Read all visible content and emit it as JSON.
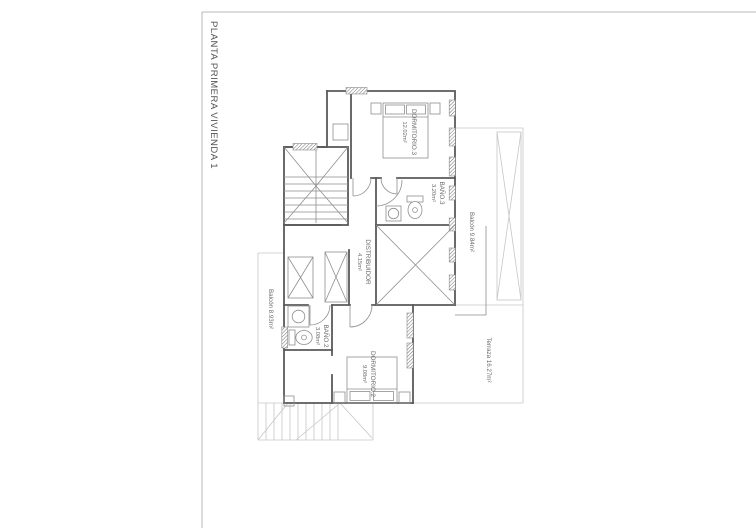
{
  "sheet": {
    "title": "PLANTA PRIMERA VIVIENDA 1"
  },
  "rooms": [
    {
      "name": "DORMITORIO.3",
      "area": "12.02m²"
    },
    {
      "name": "BAÑO.3",
      "area": "3.20m²"
    },
    {
      "name": "DISTRIBUIDOR",
      "area": "4.15m²"
    },
    {
      "name": "BAÑO.2",
      "area": "3.08m²"
    },
    {
      "name": "DORMITORIO.2",
      "area": "9.08m²"
    }
  ],
  "exterior": [
    {
      "label": "Balcón 9.84m²"
    },
    {
      "label": "Balcón 8.93m²"
    },
    {
      "label": "Terraza 16.27m²"
    }
  ],
  "colors": {
    "wall": "#5a5a5a",
    "line_medium": "#8f8f8f",
    "line_light": "#c6c6c6",
    "text": "#6b6b6b",
    "background": "#ffffff"
  }
}
